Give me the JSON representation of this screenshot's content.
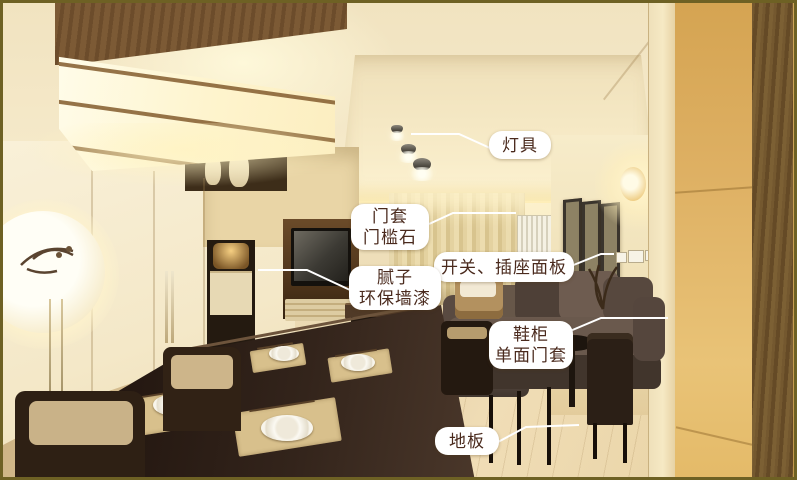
{
  "annotations": {
    "lighting": {
      "lines": [
        "灯具"
      ]
    },
    "door_casing": {
      "lines": [
        "门套",
        "门槛石"
      ]
    },
    "switch_panel": {
      "lines": [
        "开关、插座面板"
      ]
    },
    "wall_putty": {
      "lines": [
        "腻子",
        "环保墙漆"
      ]
    },
    "shoe_cabinet": {
      "lines": [
        "鞋柜",
        "单面门套"
      ]
    },
    "floor": {
      "lines": [
        "地板"
      ]
    }
  },
  "colors": {
    "label_background": "#ffffff",
    "label_text": "#4a2a1d",
    "leader_line": "#ffffff",
    "photo_border": "#6e6124",
    "wall_cream": "#f4e8c8",
    "cabinet_tan": "#e0b365",
    "floor_wood": "#e8d5a9",
    "sofa_taupe": "#5d4e44",
    "table_espresso": "#33241b"
  }
}
